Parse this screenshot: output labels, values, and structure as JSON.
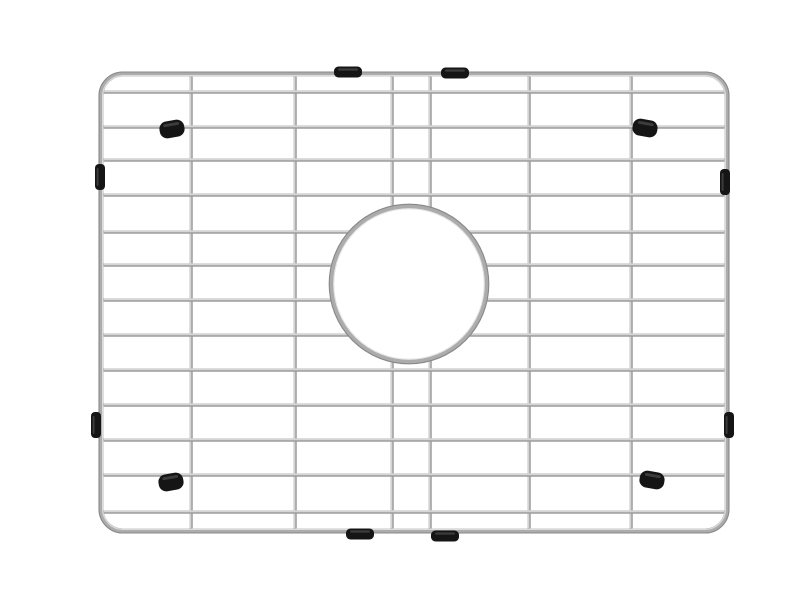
{
  "scene": {
    "description": "Product photo of a rectangular stainless steel wire sink-bottom grid with rounded corners, a circular center drain opening, and black rubber feet and edge bumpers, on a plain white background",
    "background_color": "#ffffff",
    "canvas": {
      "width": 800,
      "height": 600
    }
  },
  "grid": {
    "frame": {
      "x": 101,
      "y": 74,
      "width": 626,
      "height": 457,
      "corner_radius": 22,
      "stroke_width": 5
    },
    "horizontal_wires_y": [
      92,
      127,
      160,
      195,
      232,
      265,
      300,
      335,
      370,
      405,
      440,
      475,
      512
    ],
    "vertical_wires_x": [
      191,
      295,
      392,
      430,
      529,
      631
    ],
    "wire_stroke_width": 3.4,
    "center_ring": {
      "cx": 409,
      "cy": 284,
      "radius": 77.5,
      "stroke_width": 5,
      "mask_radius": 75
    },
    "colors": {
      "wire_light": "#e4e4e4",
      "wire_mid": "#bcbcbc",
      "wire_dark": "#8d8d8d",
      "frame_mid": "#acacac",
      "frame_edge": "#898989",
      "frame_highlight": "#dcdcdc",
      "rubber": "#151515",
      "rubber_highlight": "#3c3c3c"
    }
  },
  "bumpers": {
    "top_edge": [
      {
        "cx": 348,
        "cy": 72
      },
      {
        "cx": 455,
        "cy": 73
      }
    ],
    "bottom_edge": [
      {
        "cx": 360,
        "cy": 534
      },
      {
        "cx": 445,
        "cy": 536
      }
    ],
    "left_edge": [
      {
        "cx": 100,
        "cy": 177
      },
      {
        "cx": 96,
        "cy": 425
      }
    ],
    "right_edge": [
      {
        "cx": 725,
        "cy": 182
      },
      {
        "cx": 729,
        "cy": 425
      }
    ],
    "corner_feet": [
      {
        "cx": 172,
        "cy": 129,
        "tilt": -10
      },
      {
        "cx": 645,
        "cy": 128,
        "tilt": 10
      },
      {
        "cx": 171,
        "cy": 482,
        "tilt": -10
      },
      {
        "cx": 652,
        "cy": 480,
        "tilt": 10
      }
    ]
  }
}
